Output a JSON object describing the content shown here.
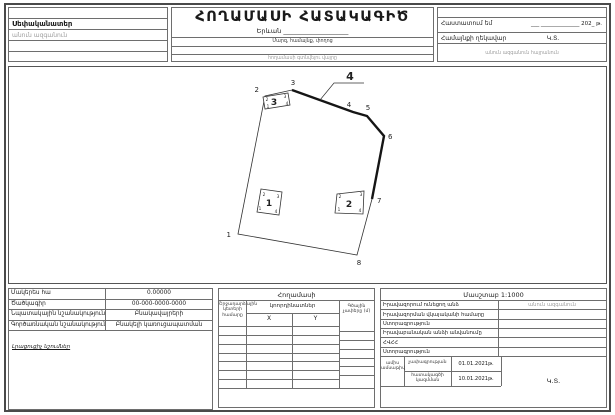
{
  "header": {
    "owner_label": "Սեփականատեր",
    "owner_placeholder": "անուն ազգանուն",
    "title": "ՀՈՂԱՄԱՍԻ ՀԱՏԱԿԱԳԻԾ",
    "city_line": "Երևան ____________________",
    "address_hint": "Մարզ, համայնք, փողոց",
    "location_hint": "հողամասի գտնվելու վայրը",
    "approve_label": "Հաստատում եմ",
    "approve_date_blank": "___ ______________ 202_ թ.",
    "head_label": "Համայնքի ղեկավար",
    "head_seal": "Կ.Տ.",
    "head_name_placeholder": "անուն ազգանուն հայրանուն"
  },
  "drawing": {
    "callout_label": "4",
    "vertex_labels": [
      "1",
      "2",
      "3",
      "4",
      "5",
      "6",
      "7",
      "8"
    ],
    "buildings": [
      {
        "label": "1",
        "corners": [
          "1",
          "2",
          "3",
          "4"
        ]
      },
      {
        "label": "2",
        "corners": [
          "1",
          "2",
          "3",
          "4"
        ]
      },
      {
        "label": "3",
        "corners": [
          "1",
          "2",
          "3",
          "4"
        ]
      }
    ]
  },
  "area_table": {
    "rows": [
      {
        "label": "Մակերես հա",
        "value": "0.00000"
      },
      {
        "label": "Ծածկագիր",
        "value": "00-000-0000-0000"
      },
      {
        "label": "Նպատակային նշանակություն",
        "value": "Բնակավայրերի"
      },
      {
        "label": "Գործառնական նշանակություն",
        "value": "Բնակելի կառուցապատման"
      }
    ],
    "notes_caption": "Լրացուցիչ նշումներ"
  },
  "coords_table": {
    "title": "Հողամասի",
    "point_col_header": "Շրջադարձային կետերի համարը",
    "coords_header": "կոորդինատներ",
    "x_label": "X",
    "y_label": "Y",
    "linear_col_header": "Գծային չափերը (մ)"
  },
  "rights_table": {
    "scale": "Մասշտաբ 1:1000",
    "rows": [
      {
        "label": "Իրավազորում ունեցող անձ",
        "value": "անուն ազգանուն"
      },
      {
        "label": "Իրավազորման վկայականի համարը",
        "value": ""
      },
      {
        "label": "Ստորագրություն",
        "value": ""
      },
      {
        "label": "Իրավաբանական անձի անվանումը",
        "value": ""
      },
      {
        "label": "ՀՎՀՀ",
        "value": ""
      },
      {
        "label": "Ստորագրություն",
        "value": ""
      }
    ],
    "dates": {
      "side_label": "ամիս ամսաթիվ",
      "survey_label": "չափագրության",
      "survey_date": "01.01.2021թ.",
      "plan_label": "հատակագծի կազմման",
      "plan_date": "10.01.2021թ."
    },
    "seal": "Կ.Տ."
  }
}
